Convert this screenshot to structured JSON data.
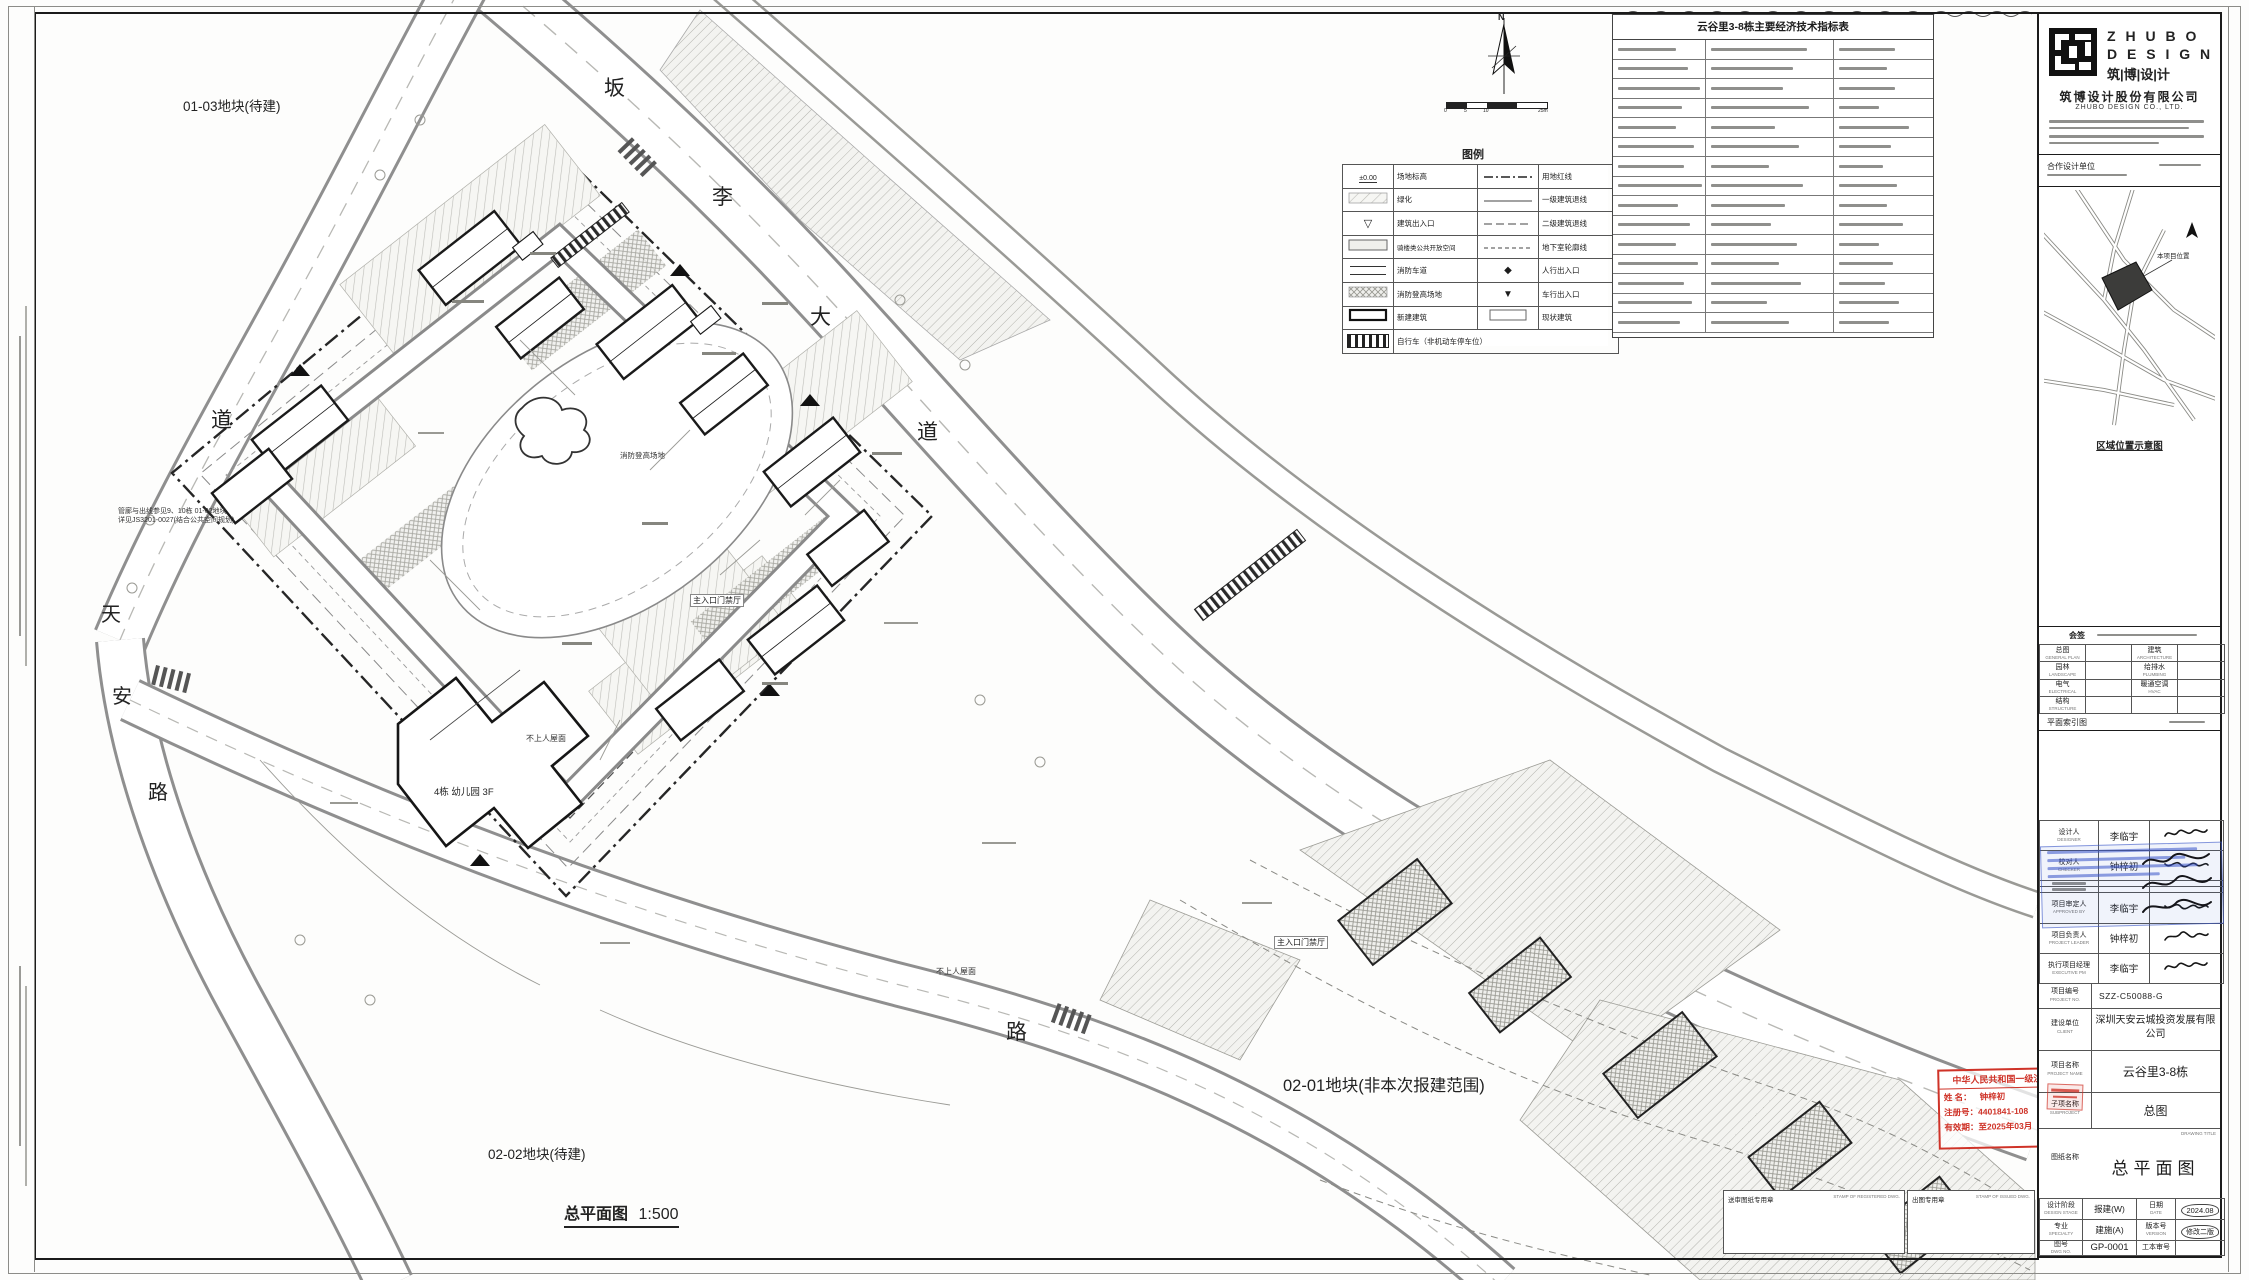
{
  "sheet": {
    "parcel_0103": "01-03地块(待建)",
    "parcel_0202": "02-02地块(待建)",
    "parcel_0201": "02-01地块(非本次报建范围)",
    "scale_title": "总平面图",
    "scale_value": "1:500",
    "roads": {
      "top": [
        "坂",
        "李",
        "大",
        "道"
      ],
      "left": [
        "道"
      ],
      "west": [
        "天",
        "安",
        "路"
      ],
      "south": [
        "路"
      ]
    },
    "labels": {
      "kindergarten": "4栋 幼儿园 3F",
      "roof1": "不上人屋面",
      "roof2": "不上人屋面",
      "gate1": "主入口门禁厅",
      "gate2": "主入口门禁厅",
      "fire_field": "消防登高场地",
      "note_line1": "管廊与出线参见9、10栋 01-02地块",
      "note_line2": "详见JS3201-0027(结合公共空间规划)"
    },
    "warning": "警示及说明 WARNING AND NOTES:",
    "compass_n": "N",
    "scalebar": [
      "0",
      "5",
      "10",
      "25m"
    ]
  },
  "legend": {
    "title": "图例",
    "elev_text": "±0.00",
    "rows": [
      {
        "l1": "场地标高",
        "l2": "用地红线"
      },
      {
        "l1": "绿化",
        "l2": "一级建筑退线"
      },
      {
        "l1": "建筑出入口",
        "l2": "二级建筑退线"
      },
      {
        "l1": "骑楼类公共开放空间",
        "l2": "地下室轮廓线"
      },
      {
        "l1": "消防车道",
        "l2": "人行出入口"
      },
      {
        "l1": "消防登高场地",
        "l2": "车行出入口"
      },
      {
        "l1": "新建建筑",
        "l2": "现状建筑"
      },
      {
        "l1": "自行车（非机动车停车位）",
        "l2": ""
      }
    ]
  },
  "econ": {
    "title": "云谷里3-8栋主要经济技术指标表"
  },
  "stamp_arch": {
    "line1": "中华人民共和国一级注册建筑师",
    "name_label": "姓 名：",
    "name": "钟梓初",
    "reg_label": "注册号：",
    "reg": "4401841-108",
    "valid_label": "有效期：",
    "valid": "至2025年03月"
  },
  "titleblock": {
    "logo_line1": "Z H U B O",
    "logo_line2": "D E S I G N",
    "logo_line3": "筑|博|设|计",
    "company_cn": "筑博设计股份有限公司",
    "company_en": "ZHUBO DESIGN CO., LTD.",
    "coop_label": "合作设计单位",
    "map_marker": "本项目位置",
    "map_caption": "区域位置示意图",
    "huiqian": "会签",
    "disciplines": [
      [
        "总图",
        "GENERAL PLAN"
      ],
      [
        "建筑",
        "ARCHITECTURE"
      ],
      [
        "园林",
        "LANDSCAPE"
      ],
      [
        "给排水",
        "PLUMBING"
      ],
      [
        "电气",
        "ELECTRICAL"
      ],
      [
        "暖通空调",
        "HVAC"
      ],
      [
        "结构",
        "STRUCTURE"
      ],
      [
        "",
        ""
      ]
    ],
    "keyplan": "平面索引图",
    "sig_rows": [
      {
        "label": "设计人",
        "en": "DESIGNER",
        "name": "李临宇"
      },
      {
        "label": "校对人",
        "en": "CHECKER",
        "name": "钟梓初"
      },
      {
        "label": "",
        "en": "",
        "name": ""
      },
      {
        "label": "",
        "en": "",
        "name": ""
      },
      {
        "label": "项目审定人",
        "en": "APPROVED BY",
        "name": "李临宇"
      },
      {
        "label": "项目负责人",
        "en": "PROJECT LEADER",
        "name": "钟梓初"
      },
      {
        "label": "执行项目经理",
        "en": "EXECUTIVE PM",
        "name": "李临宇"
      }
    ],
    "proj_no_label": "项目编号",
    "proj_no_en": "PROJECT NO.",
    "proj_no": "SZZ-C50088-G",
    "client_label": "建设单位",
    "client_en": "CLIENT",
    "client": "深圳天安云城投资发展有限公司",
    "proj_label": "项目名称",
    "proj_en": "PROJECT NAME",
    "project": "云谷里3-8栋",
    "sub_label": "子项名称",
    "sub_en": "SUBPROJECT",
    "subproject": "总图",
    "dwg_label": "图纸名称",
    "dwg_en": "DRAWING TITLE",
    "drawing": "总平面图",
    "grid": {
      "stage_label": "设计阶段",
      "stage_en": "DESIGN STAGE",
      "stage": "报建(W)",
      "date_label": "日期",
      "date_en": "DATE",
      "date": "2024.08",
      "spec_label": "专业",
      "spec_en": "SPECIALTY",
      "spec": "建施(A)",
      "ver_label": "版本号",
      "ver_en": "VERSION",
      "ver": "修改二版",
      "no_label": "图号",
      "no_en": "DWG NO.",
      "no": "GP-0001",
      "ref_label": "工本审号",
      "ref_en": "",
      "ref": ""
    },
    "stampbox_a": "送审图纸专用章",
    "stampbox_a_en": "STAMP OF REGISTERED DWG.",
    "stampbox_b": "出图专用章",
    "stampbox_b_en": "STAMP OF ISSUED DWG."
  }
}
